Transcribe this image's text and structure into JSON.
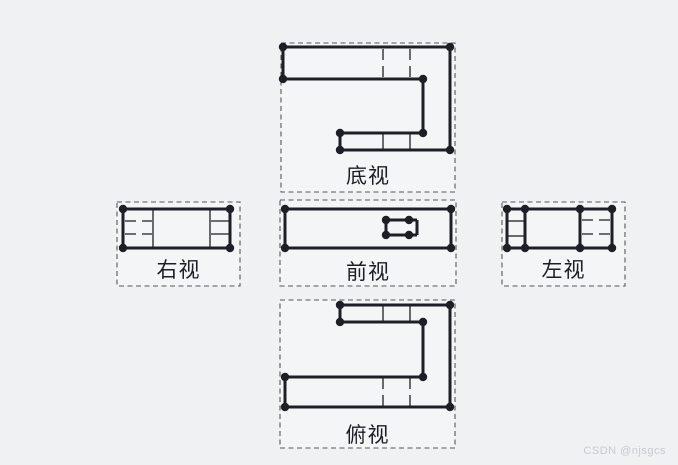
{
  "page": {
    "background": "#f0f1f3",
    "watermark": {
      "text": "CSDN @njsgcs",
      "color": "#c8cad1"
    }
  },
  "drawing": {
    "stroke_color": "#1c1f26",
    "box_fill": "#f4f5f7",
    "box_border_color": "#55565a",
    "label_color": "#1b1e24",
    "views": [
      {
        "id": "bottom-view",
        "label": "底视",
        "box": [
          281,
          43,
          174,
          149
        ],
        "thick": [
          [
            283,
            47,
            450,
            47
          ],
          [
            283,
            47,
            283,
            79
          ],
          [
            283,
            79,
            423,
            79
          ],
          [
            423,
            79,
            423,
            133
          ],
          [
            340,
            133,
            423,
            133
          ],
          [
            340,
            133,
            340,
            150
          ],
          [
            340,
            150,
            450,
            150
          ],
          [
            450,
            47,
            450,
            150
          ]
        ],
        "thin_solid": [
          [
            383,
            134,
            383,
            149
          ],
          [
            410,
            134,
            410,
            149
          ]
        ],
        "thin_dashed": [
          [
            383,
            49,
            383,
            78
          ],
          [
            410,
            49,
            410,
            78
          ]
        ],
        "dots": [
          [
            283,
            47
          ],
          [
            450,
            47
          ],
          [
            283,
            79
          ],
          [
            423,
            79
          ],
          [
            423,
            133
          ],
          [
            340,
            133
          ],
          [
            340,
            150
          ],
          [
            450,
            150
          ]
        ]
      },
      {
        "id": "right-view",
        "label": "右视",
        "box": [
          117,
          202,
          123,
          84
        ],
        "thick": [
          [
            123,
            209,
            230,
            209
          ],
          [
            123,
            248,
            230,
            248
          ],
          [
            123,
            209,
            123,
            248
          ],
          [
            230,
            209,
            230,
            248
          ]
        ],
        "thin_solid": [
          [
            153,
            210,
            153,
            247
          ],
          [
            210,
            210,
            210,
            247
          ],
          [
            211,
            221,
            229,
            221
          ],
          [
            211,
            234,
            229,
            234
          ]
        ],
        "thin_dashed": [
          [
            125,
            221,
            152,
            221
          ],
          [
            125,
            234,
            152,
            234
          ]
        ],
        "dots": [
          [
            123,
            209
          ],
          [
            230,
            209
          ],
          [
            123,
            248
          ],
          [
            230,
            248
          ]
        ]
      },
      {
        "id": "front-view",
        "label": "前视",
        "box": [
          280,
          200,
          176,
          86
        ],
        "thick": [
          [
            285,
            209,
            451,
            209
          ],
          [
            285,
            248,
            451,
            248
          ],
          [
            285,
            209,
            285,
            248
          ],
          [
            451,
            209,
            451,
            248
          ],
          [
            386,
            220,
            417,
            220
          ],
          [
            386,
            235,
            417,
            235
          ],
          [
            386,
            220,
            386,
            235
          ],
          [
            417,
            220,
            417,
            235
          ]
        ],
        "thin_solid": [],
        "thin_dashed": [],
        "dots": [
          [
            285,
            209
          ],
          [
            451,
            209
          ],
          [
            285,
            248
          ],
          [
            451,
            248
          ],
          [
            386,
            220
          ],
          [
            409,
            220
          ],
          [
            386,
            235
          ],
          [
            409,
            235
          ]
        ]
      },
      {
        "id": "left-view",
        "label": "左视",
        "box": [
          502,
          202,
          123,
          84
        ],
        "thick": [
          [
            507,
            209,
            612,
            209
          ],
          [
            507,
            248,
            612,
            248
          ],
          [
            507,
            209,
            507,
            248
          ],
          [
            612,
            209,
            612,
            248
          ],
          [
            525,
            209,
            525,
            248
          ],
          [
            580,
            209,
            580,
            248
          ]
        ],
        "thin_solid": [
          [
            508,
            221,
            524,
            221
          ],
          [
            508,
            236,
            524,
            236
          ]
        ],
        "thin_dashed": [
          [
            582,
            220,
            610,
            220
          ],
          [
            582,
            234,
            610,
            234
          ]
        ],
        "dots": [
          [
            507,
            209
          ],
          [
            612,
            209
          ],
          [
            507,
            248
          ],
          [
            612,
            248
          ],
          [
            525,
            209
          ],
          [
            525,
            248
          ],
          [
            580,
            209
          ],
          [
            580,
            248
          ]
        ]
      },
      {
        "id": "top-view",
        "label": "俯视",
        "box": [
          280,
          300,
          175,
          148
        ],
        "thick": [
          [
            340,
            305,
            450,
            305
          ],
          [
            340,
            305,
            340,
            322
          ],
          [
            340,
            322,
            423,
            322
          ],
          [
            423,
            322,
            423,
            377
          ],
          [
            285,
            377,
            423,
            377
          ],
          [
            285,
            377,
            285,
            407
          ],
          [
            285,
            407,
            450,
            407
          ],
          [
            450,
            305,
            450,
            407
          ]
        ],
        "thin_solid": [
          [
            383,
            306,
            383,
            321
          ],
          [
            410,
            306,
            410,
            321
          ]
        ],
        "thin_dashed": [
          [
            383,
            378,
            383,
            406
          ],
          [
            410,
            378,
            410,
            406
          ]
        ],
        "dots": [
          [
            340,
            305
          ],
          [
            450,
            305
          ],
          [
            340,
            322
          ],
          [
            423,
            322
          ],
          [
            423,
            377
          ],
          [
            285,
            377
          ],
          [
            285,
            407
          ],
          [
            450,
            407
          ]
        ]
      }
    ]
  }
}
